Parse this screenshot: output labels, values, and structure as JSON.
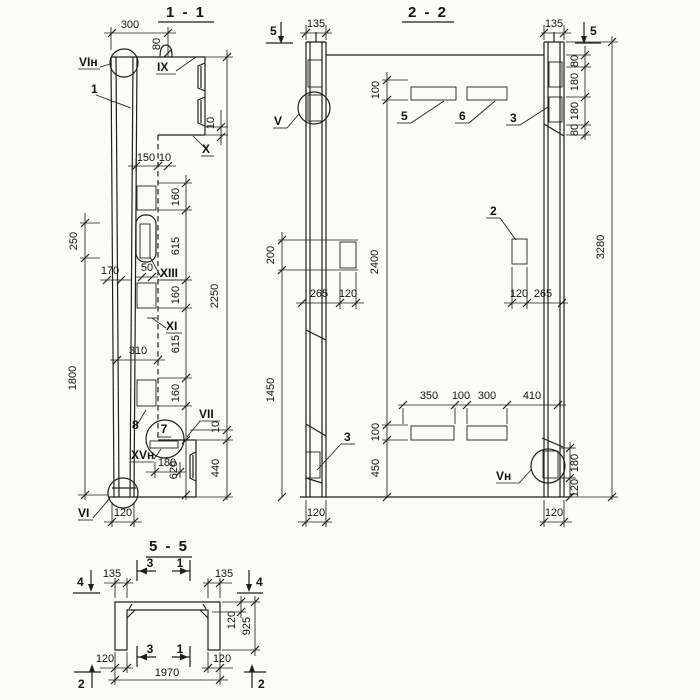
{
  "s11": {
    "title": "1 - 1",
    "d300": "300",
    "d80": "80",
    "d10a": "10",
    "d150": "150",
    "d10b": "10",
    "d160a": "160",
    "d615a": "615",
    "d250": "250",
    "d170": "170",
    "d50": "50",
    "d2250": "2250",
    "d160b": "160",
    "d310": "310",
    "d615b": "615",
    "d1800": "1800",
    "d160c": "160",
    "d10c": "10",
    "d180": "180",
    "d620": "620",
    "d440": "440",
    "d120": "120",
    "mVIn": "VIн",
    "mIX": "IX",
    "m1": "1",
    "mX": "X",
    "mXIII": "XIII",
    "mXI": "XI",
    "m8": "8",
    "m7": "7",
    "mVII": "VII",
    "mXVn": "XVн",
    "mVI": "VI"
  },
  "s22": {
    "title": "2 - 2",
    "c5l": "5",
    "d135l": "135",
    "d135r": "135",
    "c5r": "5",
    "d80a": "80",
    "d180a": "180",
    "d180b": "180",
    "d80b": "80",
    "d100a": "100",
    "m5": "5",
    "m6": "6",
    "m3a": "3",
    "mV": "V",
    "d200": "200",
    "d2400": "2400",
    "d3280": "3280",
    "d265l": "265",
    "d120l": "120",
    "m2": "2",
    "d120r": "120",
    "d265r": "265",
    "d1450": "1450",
    "m3b": "3",
    "d100b": "100",
    "d450": "450",
    "d350": "350",
    "d100c": "100",
    "d300": "300",
    "d410": "410",
    "mVn": "Vн",
    "d180c": "180",
    "d120c": "120",
    "d120bl": "120",
    "d120br": "120"
  },
  "s55": {
    "title": "5 - 5",
    "c4l": "4",
    "d135l": "135",
    "c3t": "3",
    "c1t": "1",
    "d135r": "135",
    "c4r": "4",
    "d120t": "120",
    "d925": "925",
    "d120bl": "120",
    "c3b": "3",
    "c1b": "1",
    "d120br": "120",
    "d1970": "1970",
    "c2l": "2",
    "c2r": "2"
  }
}
